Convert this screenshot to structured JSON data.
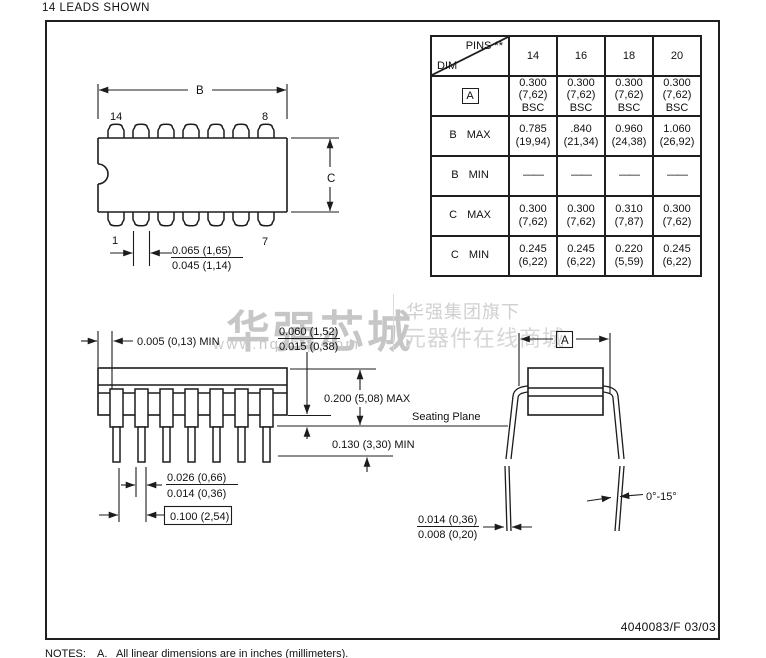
{
  "page": {
    "heading": "14 LEADS SHOWN",
    "doc_number": "4040083/F  03/03",
    "notes_label": "NOTES:",
    "note_a_index": "A.",
    "note_a_text": "All linear dimensions are in inches (millimeters)."
  },
  "watermark": {
    "logo_text": "华强芯城",
    "logo_url": "www.hqchip.com",
    "tagline_line1": "华强集团旗下",
    "tagline_line2": "元器件在线商城",
    "color": "#c9c9c9"
  },
  "dim_table": {
    "pins_label": "PINS **",
    "dim_label": "DIM",
    "columns": [
      "14",
      "16",
      "18",
      "20"
    ],
    "rows": [
      {
        "label": "A",
        "cells": [
          "0.300\n(7,62)\nBSC",
          "0.300\n(7,62)\nBSC",
          "0.300\n(7,62)\nBSC",
          "0.300\n(7,62)\nBSC"
        ]
      },
      {
        "label": "B MAX",
        "cells": [
          "0.785\n(19,94)",
          ".840\n(21,34)",
          "0.960\n(24,38)",
          "1.060\n(26,92)"
        ]
      },
      {
        "label": "B MIN",
        "cells": [
          "——",
          "——",
          "——",
          "——"
        ]
      },
      {
        "label": "C MAX",
        "cells": [
          "0.300\n(7,62)",
          "0.300\n(7,62)",
          "0.310\n(7,87)",
          "0.300\n(7,62)"
        ]
      },
      {
        "label": "C MIN",
        "cells": [
          "0.245\n(6,22)",
          "0.245\n(6,22)",
          "0.220\n(5,59)",
          "0.245\n(6,22)"
        ]
      }
    ]
  },
  "top_view": {
    "dim_b": "B",
    "dim_c": "C",
    "pin_top_left": "14",
    "pin_top_right": "8",
    "pin_bottom_left": "1",
    "pin_bottom_right": "7",
    "lead_width_max": "0.065 (1,65)",
    "lead_width_min": "0.045 (1,14)"
  },
  "side_view": {
    "edge_gap": "0.005 (0,13) MIN",
    "standoff_max": "0.060 (1,52)",
    "standoff_min": "0.015 (0,38)",
    "body_height": "0.200 (5,08) MAX",
    "seating_plane": "Seating Plane",
    "lead_below_seating": "0.130 (3,30) MIN",
    "lead_thickness_max": "0.026 (0,66)",
    "lead_thickness_min": "0.014 (0,36)",
    "lead_pitch": "0.100 (2,54)"
  },
  "end_view": {
    "dim_a": "A",
    "lead_angle": "0°-15°",
    "tip_width_max": "0.014 (0,36)",
    "tip_width_min": "0.008 (0,20)"
  }
}
